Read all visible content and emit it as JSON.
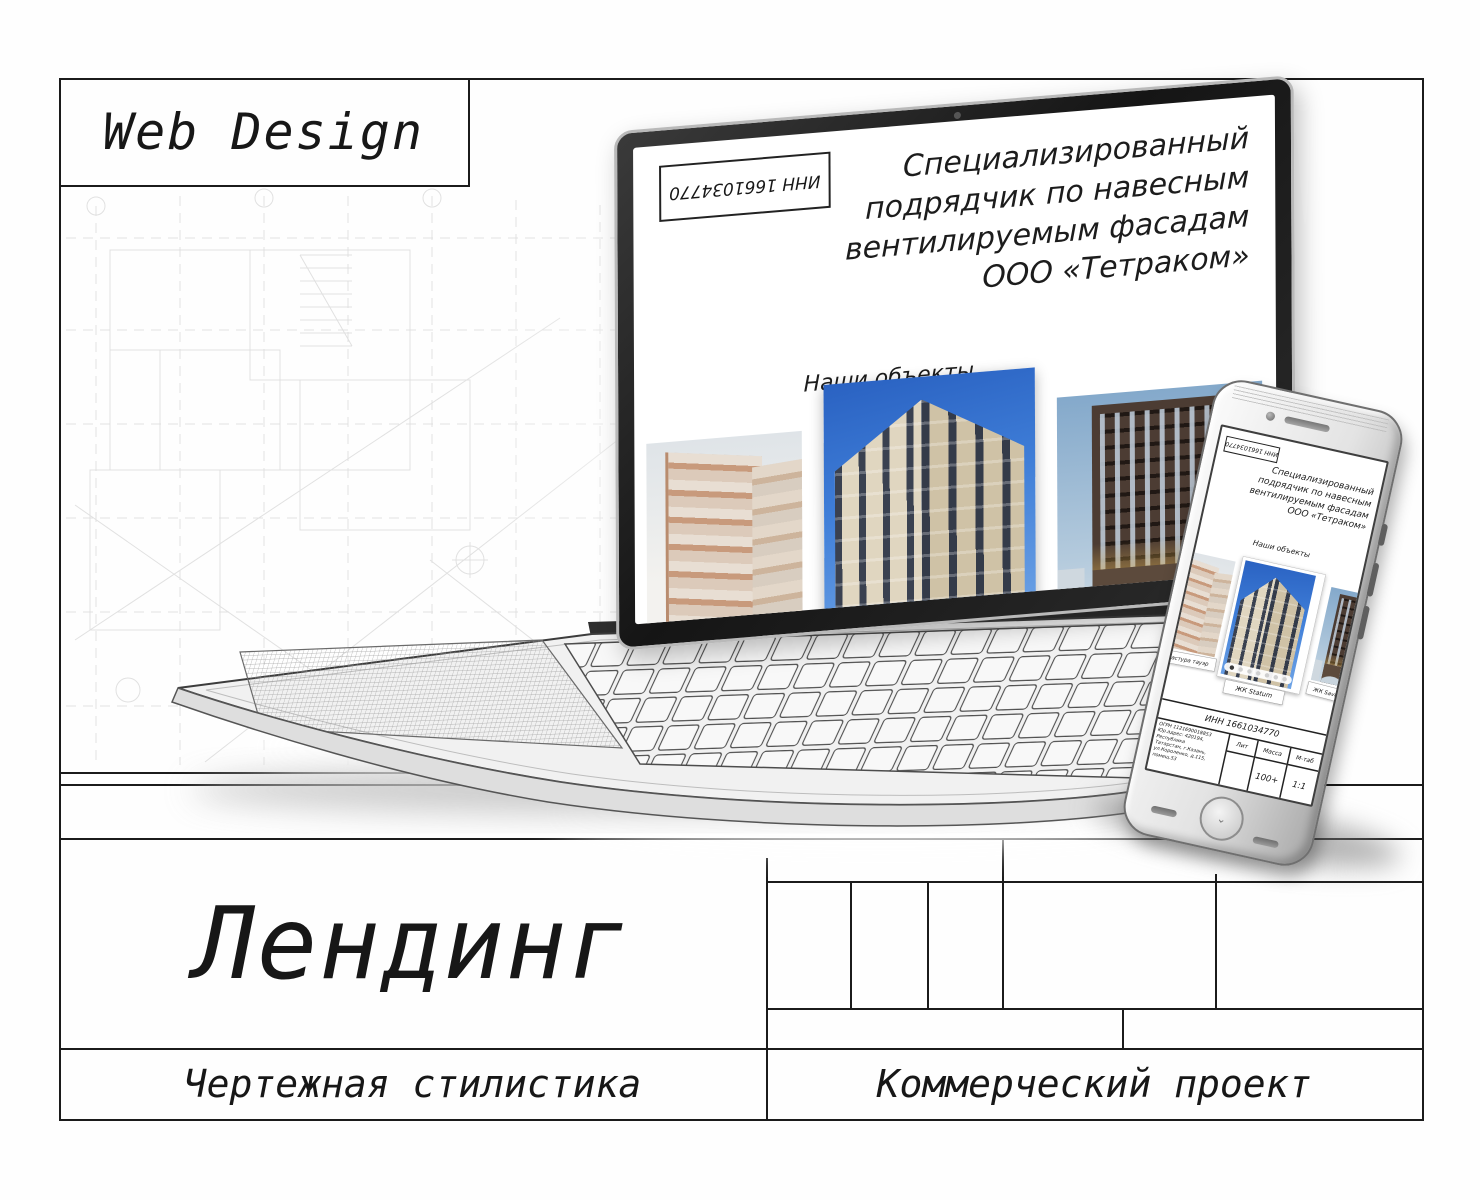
{
  "sheet": {
    "category_label": "Web Design",
    "title": "Лендинг",
    "style_label": "Чертежная стилистика",
    "project_type_label": "Коммерческий проект"
  },
  "landing": {
    "inn_stamp": "ИНН 1661034770",
    "hero_lines": [
      "Специализированный",
      "подрядчик по навесным",
      "вентилируемым фасадам",
      "ООО «Тетраком»"
    ],
    "section_heading": "Наши объекты",
    "projects": [
      {
        "label": "Мастура тауэр"
      },
      {
        "label": "ЖК Statum"
      },
      {
        "label": "ЖК Savin Premium"
      }
    ],
    "footer": {
      "inn": "ИНН 1661034770",
      "company_lines": [
        "ОГРН 1121690018853",
        "Юр.адрес: 420194, Республика",
        "Татарстан, г.Казань,",
        "ул.Короленко, д.115, помещ.53"
      ],
      "table": {
        "lit_label": "Лит",
        "mass_label": "Масса",
        "scale_label": "М-таб",
        "mass_value": "100+",
        "scale_value": "1:1"
      }
    }
  },
  "colors": {
    "line": "#1b1b1b",
    "sky_blue": "#3a77d2"
  }
}
